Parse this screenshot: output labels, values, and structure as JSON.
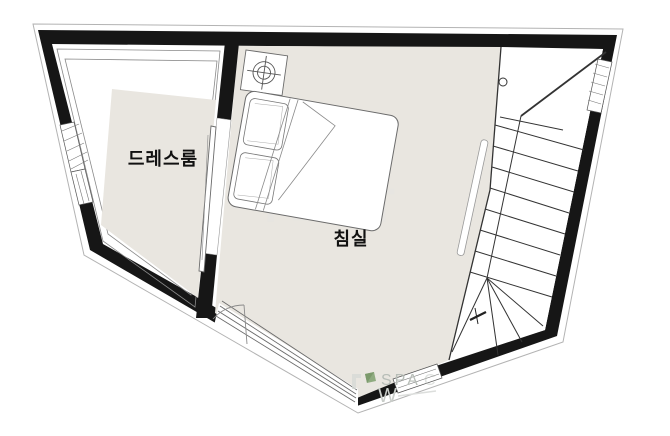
{
  "plan": {
    "rooms": {
      "dressroom": {
        "label": "드레스룸"
      },
      "bedroom": {
        "label": "침실"
      }
    },
    "watermarks": {
      "center": "더존하",
      "brand_text": "SPA",
      "brand_text_faint": "C",
      "brand_w": "W"
    },
    "colors": {
      "wall": "#161616",
      "floor": "#e9e6e0",
      "outer_outline": "#b3b3b3",
      "furniture_line": "#6b6b6b",
      "stair_line": "#333333",
      "label": "#111111",
      "watermark_gray": "#e7e5e1",
      "brand_gray": "#b7bdb7",
      "brand_light": "#c9cdc9",
      "brand_green": "#8fab80",
      "brand_green_dark": "#7c9a6c"
    }
  }
}
